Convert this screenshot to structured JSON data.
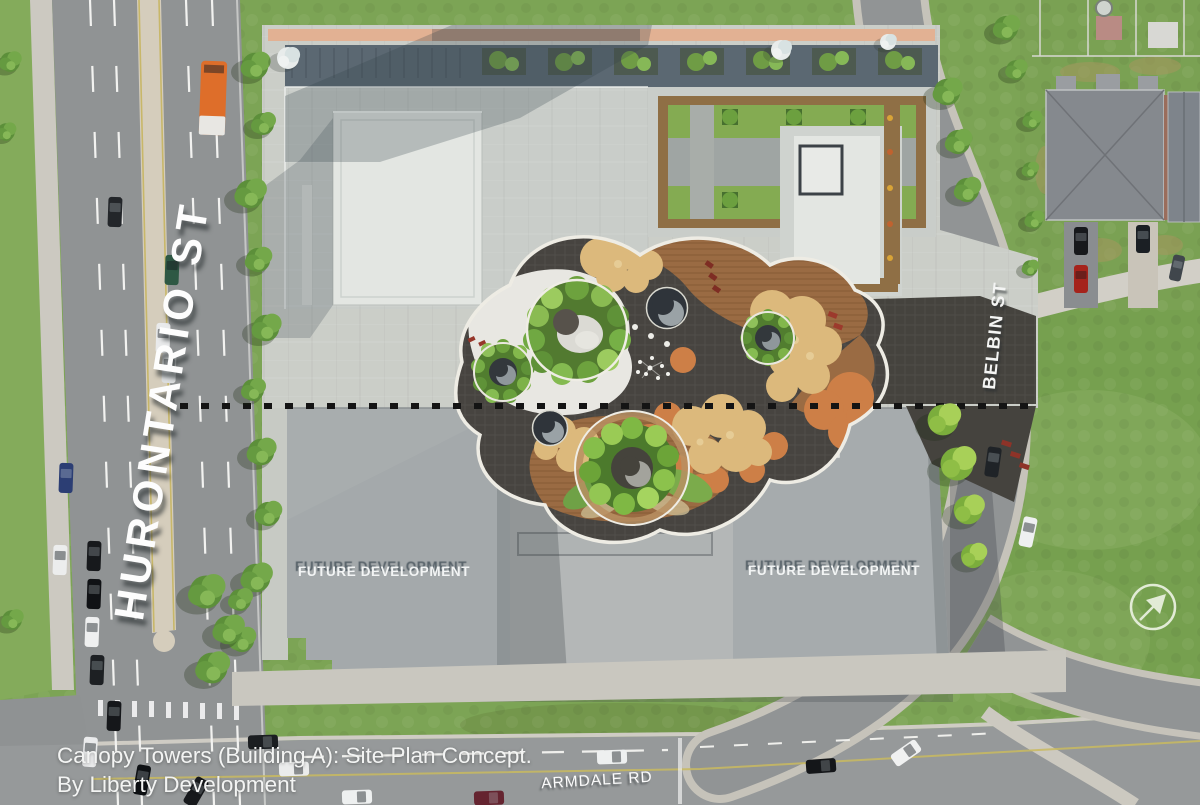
{
  "scene": {
    "streets": {
      "hurontario": "HURONTARIO ST",
      "belbin": "BELBIN ST",
      "armdale": "ARMDALE RD"
    },
    "parcels": {
      "future_left": "FUTURE DEVELOPMENT",
      "future_right": "FUTURE DEVELOPMENT"
    },
    "caption": {
      "line1": "Canopy Towers (Building A): Site Plan Concept.",
      "line2": "By Liberty Development"
    },
    "compass": "north-east-arrow",
    "colors": {
      "grass": "#7CA455",
      "asphalt": "#909394",
      "plaza_concrete": "#CBCEC8",
      "median": "#D5CDBC",
      "future_block_gray": "#A6ABAD",
      "courtyard_paving": "#474440",
      "wood_deck": "#9A6B43",
      "play_surface_tan": "#DCB97C",
      "play_surface_orange": "#CD7F47",
      "planting_green": "#6FA143",
      "bus_orange": "#DE6E2A",
      "label_white": "#F4F5F4"
    }
  }
}
